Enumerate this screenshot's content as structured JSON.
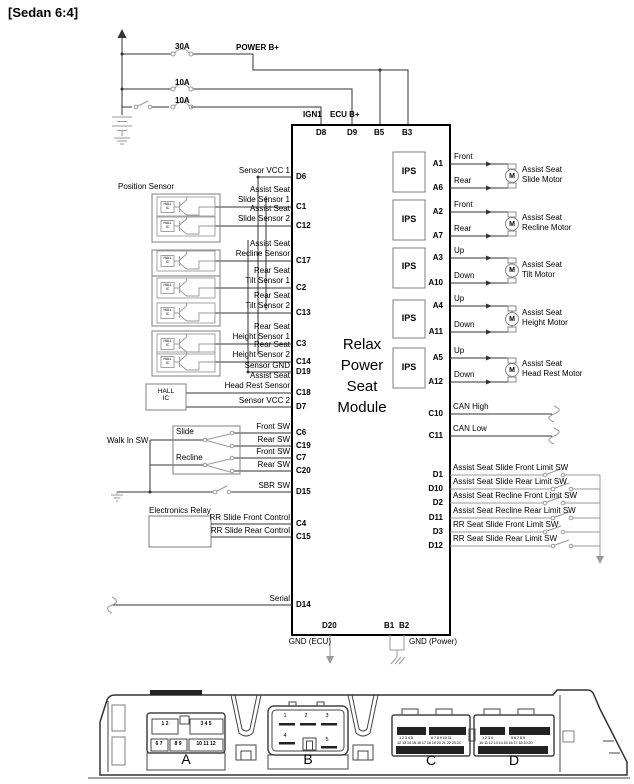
{
  "header": {
    "title": "[Sedan 6:4]"
  },
  "power": {
    "fuse_30a": "30A",
    "fuse_10a_1": "10A",
    "fuse_10a_2": "10A",
    "power_b_plus": "POWER B+",
    "ign1": "IGN1",
    "ecu_b_plus": "ECU B+"
  },
  "module": {
    "title": "Relax\nPower\nSeat\nModule",
    "pins_top": {
      "d8": "D8",
      "d9": "D9",
      "b5": "B5",
      "b3": "B3"
    },
    "pins_bottom": {
      "d20": "D20",
      "b1": "B1",
      "b2": "B2"
    },
    "gnd_ecu": "GND (ECU)",
    "gnd_power": "GND (Power)"
  },
  "sensors": {
    "section_label": "Position Sensor",
    "hall_ic_box": "HALL\nIC",
    "hall_ic_small": "HALL\nIC",
    "rows": [
      {
        "label": "Sensor VCC 1",
        "pin": "D6"
      },
      {
        "label": "Assist Seat\nSlide Sensor 1",
        "pin": "C1"
      },
      {
        "label": "Assist Seat\nSlide Sensor 2",
        "pin": "C12"
      },
      {
        "label": "Assist Seat\nRecline Sensor",
        "pin": "C17"
      },
      {
        "label": "Rear Seat\nTilt Sensor 1",
        "pin": "C2"
      },
      {
        "label": "Rear Seat\nTilt Sensor 2",
        "pin": "C13"
      },
      {
        "label": "Rear Seat\nHeight Sensor 1",
        "pin": "C3"
      },
      {
        "label": "Rear Seat\nHeight Sensor 2",
        "pin": "C14"
      },
      {
        "label": "Sensor GND",
        "pin": "D19"
      },
      {
        "label": "Assist Seat\nHead Rest Sensor",
        "pin": "C18"
      },
      {
        "label": "Sensor VCC 2",
        "pin": "D7"
      }
    ]
  },
  "switches": {
    "walk_in_label": "Walk In SW",
    "slide": "Slide",
    "recline": "Recline",
    "rows": [
      {
        "label": "Front SW",
        "pin": "C6"
      },
      {
        "label": "Rear SW",
        "pin": "C19"
      },
      {
        "label": "Front SW",
        "pin": "C7"
      },
      {
        "label": "Rear SW",
        "pin": "C20"
      }
    ],
    "sbr": {
      "label": "SBR SW",
      "pin": "D15"
    },
    "relay_label": "Electronics Relay",
    "relay_rows": [
      {
        "label": "RR Slide Front Control",
        "pin": "C4"
      },
      {
        "label": "RR Slide Rear Control",
        "pin": "C15"
      }
    ],
    "serial": {
      "label": "Serial",
      "pin": "D14"
    }
  },
  "outputs": {
    "ips": "IPS",
    "motor_symbol": "M",
    "motors": [
      {
        "pin_a": "A1",
        "dir_a": "Front",
        "pin_b": "A6",
        "dir_b": "Rear",
        "name": "Assist Seat\nSlide Motor"
      },
      {
        "pin_a": "A2",
        "dir_a": "Front",
        "pin_b": "A7",
        "dir_b": "Rear",
        "name": "Assist Seat\nRecline Motor"
      },
      {
        "pin_a": "A3",
        "dir_a": "Up",
        "pin_b": "A10",
        "dir_b": "Down",
        "name": "Assist Seat\nTilt Motor"
      },
      {
        "pin_a": "A4",
        "dir_a": "Up",
        "pin_b": "A11",
        "dir_b": "Down",
        "name": "Assist Seat\nHeight Motor"
      },
      {
        "pin_a": "A5",
        "dir_a": "Up",
        "pin_b": "A12",
        "dir_b": "Down",
        "name": "Assist Seat\nHead Rest Motor"
      }
    ],
    "can": [
      {
        "label": "CAN High",
        "pin": "C10"
      },
      {
        "label": "CAN Low",
        "pin": "C11"
      }
    ],
    "limit_switches": [
      {
        "label": "Assist Seat Slide Front Limit SW",
        "pin": "D1"
      },
      {
        "label": "Assist Seat Slide Rear Limit SW",
        "pin": "D10"
      },
      {
        "label": "Assist Seat Recline Front Limit SW",
        "pin": "D2"
      },
      {
        "label": "Assist Seat Recline Rear Limit SW",
        "pin": "D11"
      },
      {
        "label": "RR Seat Slide Front Limit SW",
        "pin": "D3"
      },
      {
        "label": "RR Seat Slide Rear Limit SW",
        "pin": "D12"
      }
    ]
  },
  "connector_view": {
    "a": {
      "label": "A",
      "top_left": "1 2",
      "top_right": "3 4 5",
      "bottom_left": "6 7",
      "bottom_mid": "8 9",
      "bottom_right": "10 11 12"
    },
    "b": {
      "label": "B",
      "p1": "1",
      "p2": "2",
      "p3": "3",
      "p4": "4",
      "p5": "5"
    },
    "c": {
      "label": "C",
      "row1_left": "1 2 3 4 5",
      "row1_right": "6 7 8 9 10 11",
      "row2": "12 13 14 15 16 17 18 19 20 21 22 23 24"
    },
    "d": {
      "label": "D",
      "row1_left": "1 2 3 4",
      "row1_right": "5 6 7 8 9",
      "row2": "10 11 12 13 14 15 16 17 18 19 20"
    }
  },
  "colors": {
    "wire": "#333333",
    "symbol": "#9a9a9a",
    "module_border": "#000000"
  }
}
